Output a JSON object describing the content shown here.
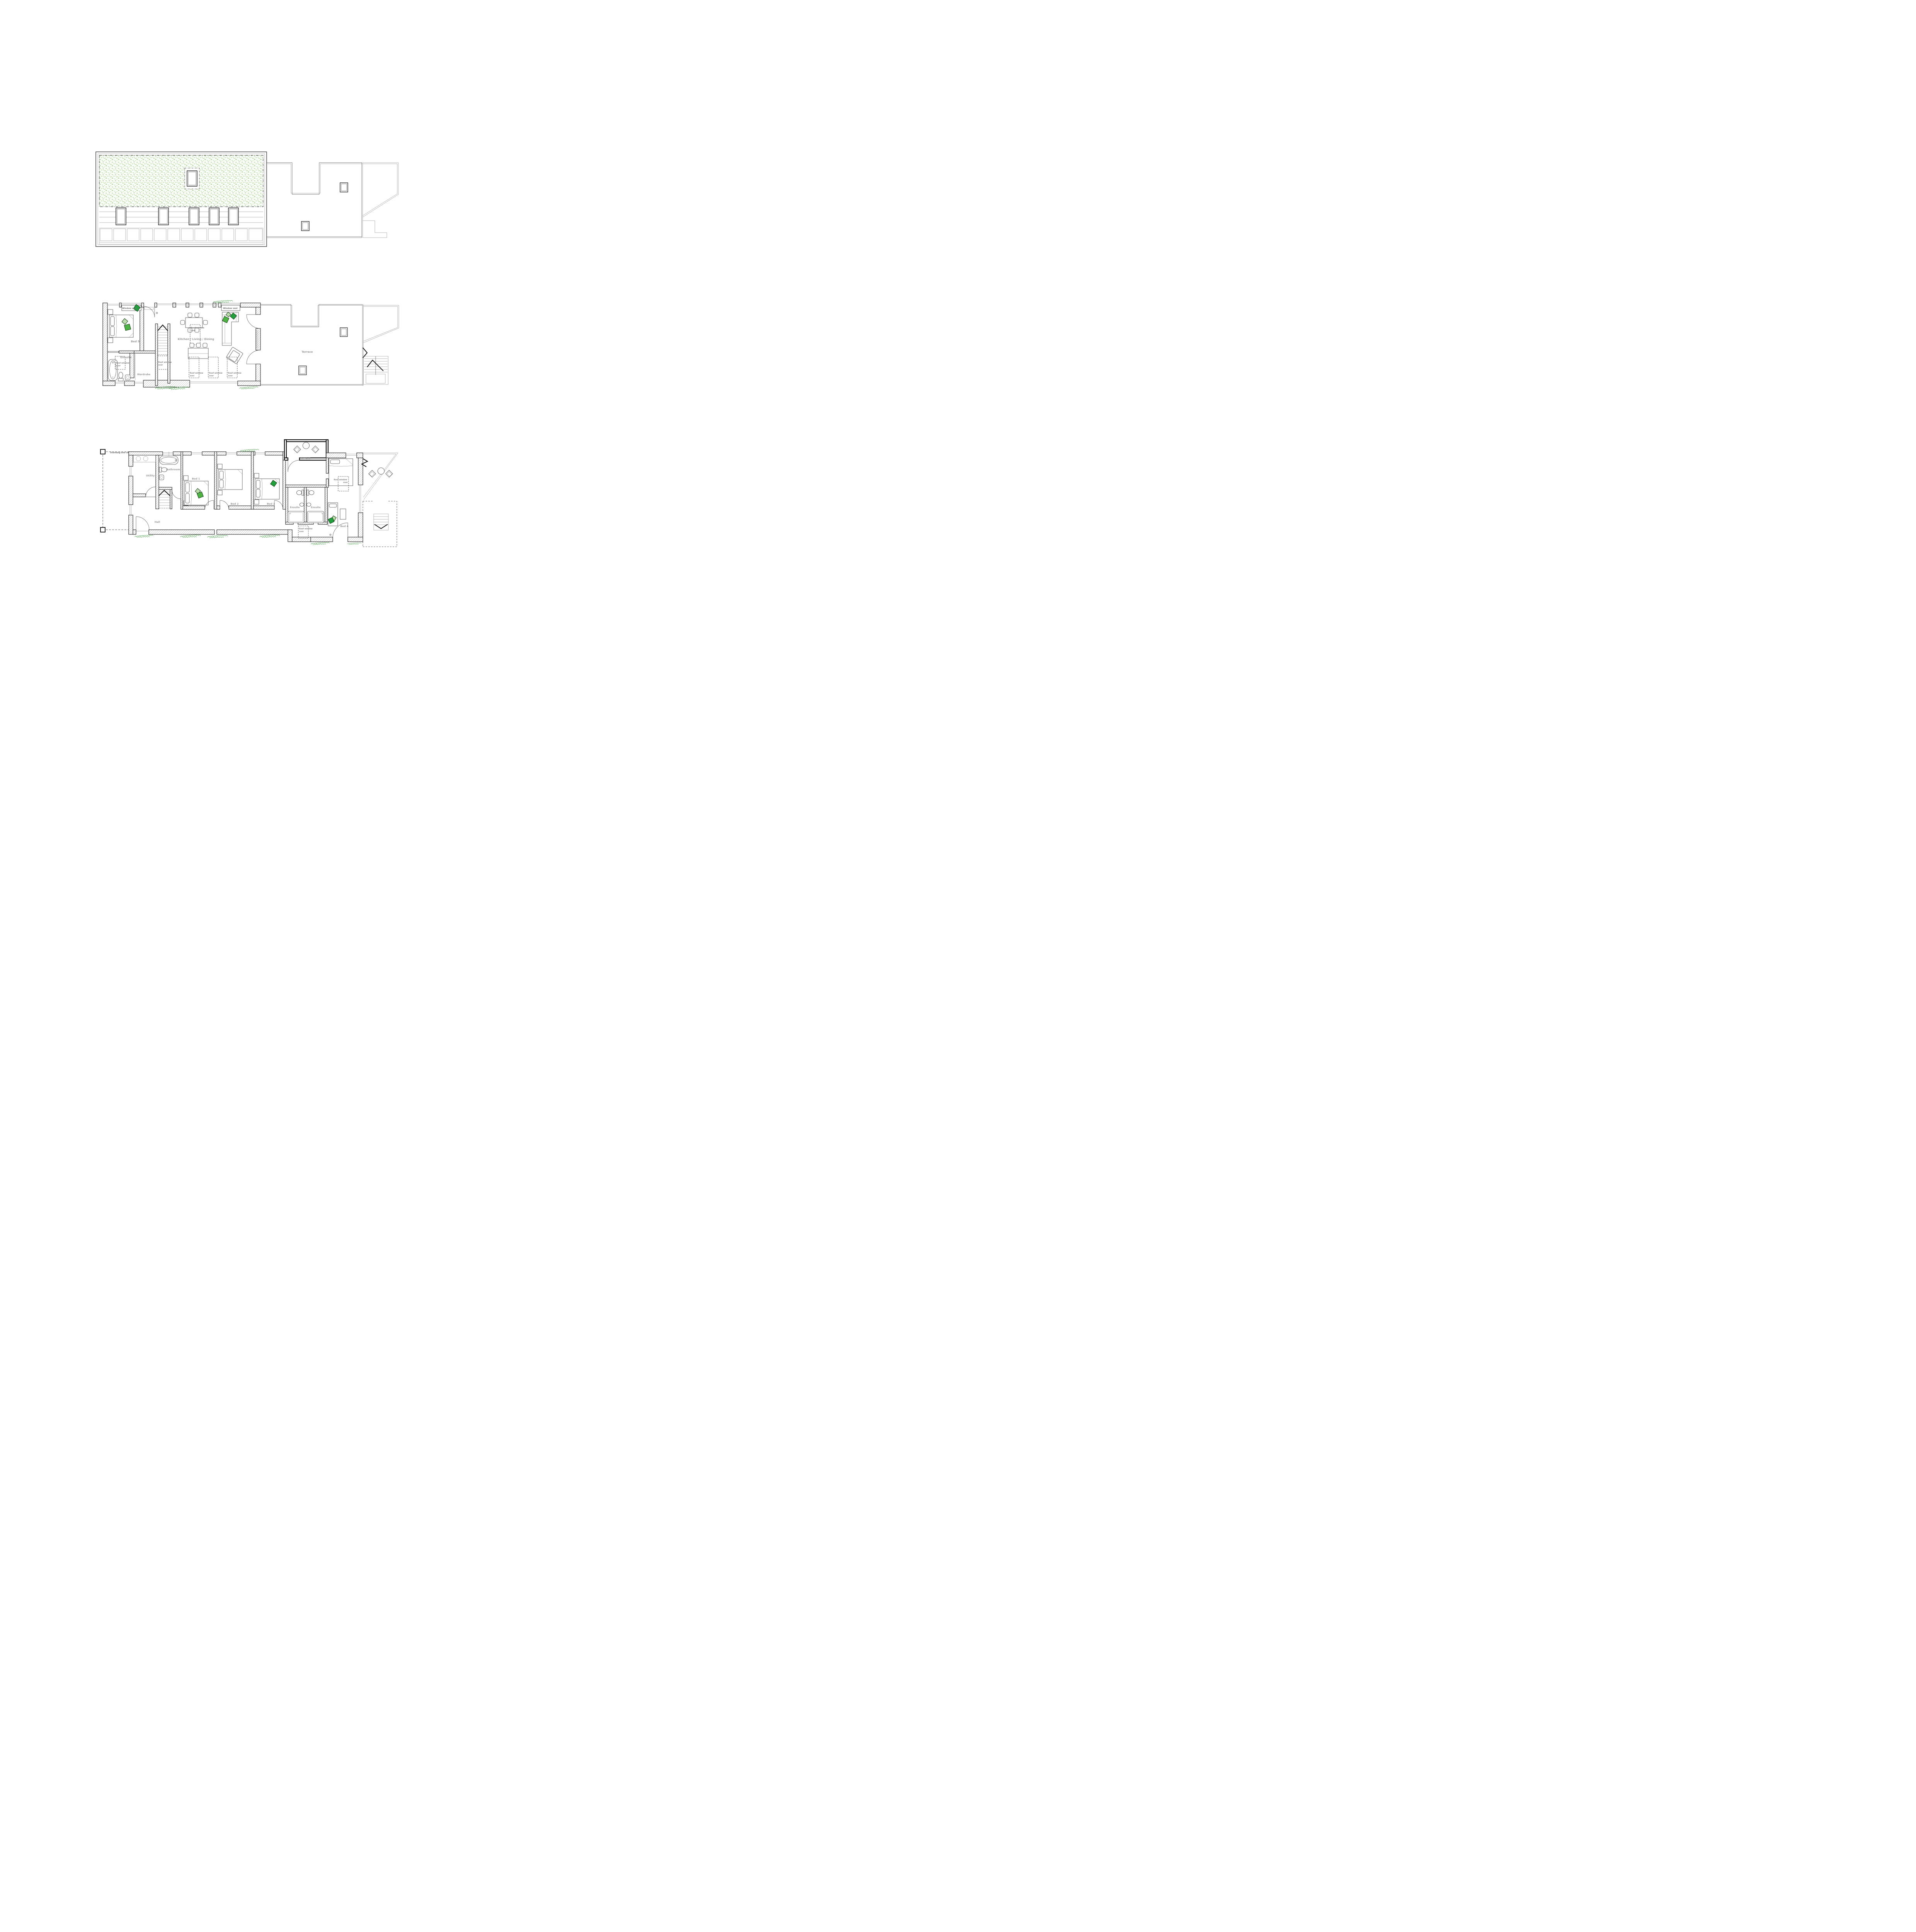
{
  "palette": {
    "wall_line": "#1b1b1b",
    "hatch_gray": "#ababab",
    "label_gray": "#9b9b9b",
    "note_gray": "#8a8a8a",
    "cushion_green_bright": "#4fb244",
    "cushion_green_dark": "#21a03d",
    "cushion_green_light": "#b9dcaa",
    "sedum_green": "#cde5c0",
    "shrub_green": "#3f9b3f"
  },
  "first_floor": {
    "bed5": "Bed 5",
    "ensuite": "Ensuite",
    "wardrobe": "Wardrobe",
    "kitchen_living_dining": "Kitchen / Living / Dining",
    "terrace": "Terrace",
    "window_seat": "Window seat",
    "roof_window_line1": "Roof window",
    "roof_window_line2": "over"
  },
  "ground_floor": {
    "overhang_note": "Overhang over shown dashed",
    "utility": "Utility",
    "bathroom": "Bathroom",
    "bed1": "Bed 1",
    "bed2": "Bed 2",
    "bed3": "Bed 3",
    "bed4": "Bed 4",
    "ensuite": "Ensuite",
    "hall": "Hall",
    "terrace": "Terrace",
    "roof_window_line1": "Roof window",
    "roof_window_line2": "over"
  }
}
